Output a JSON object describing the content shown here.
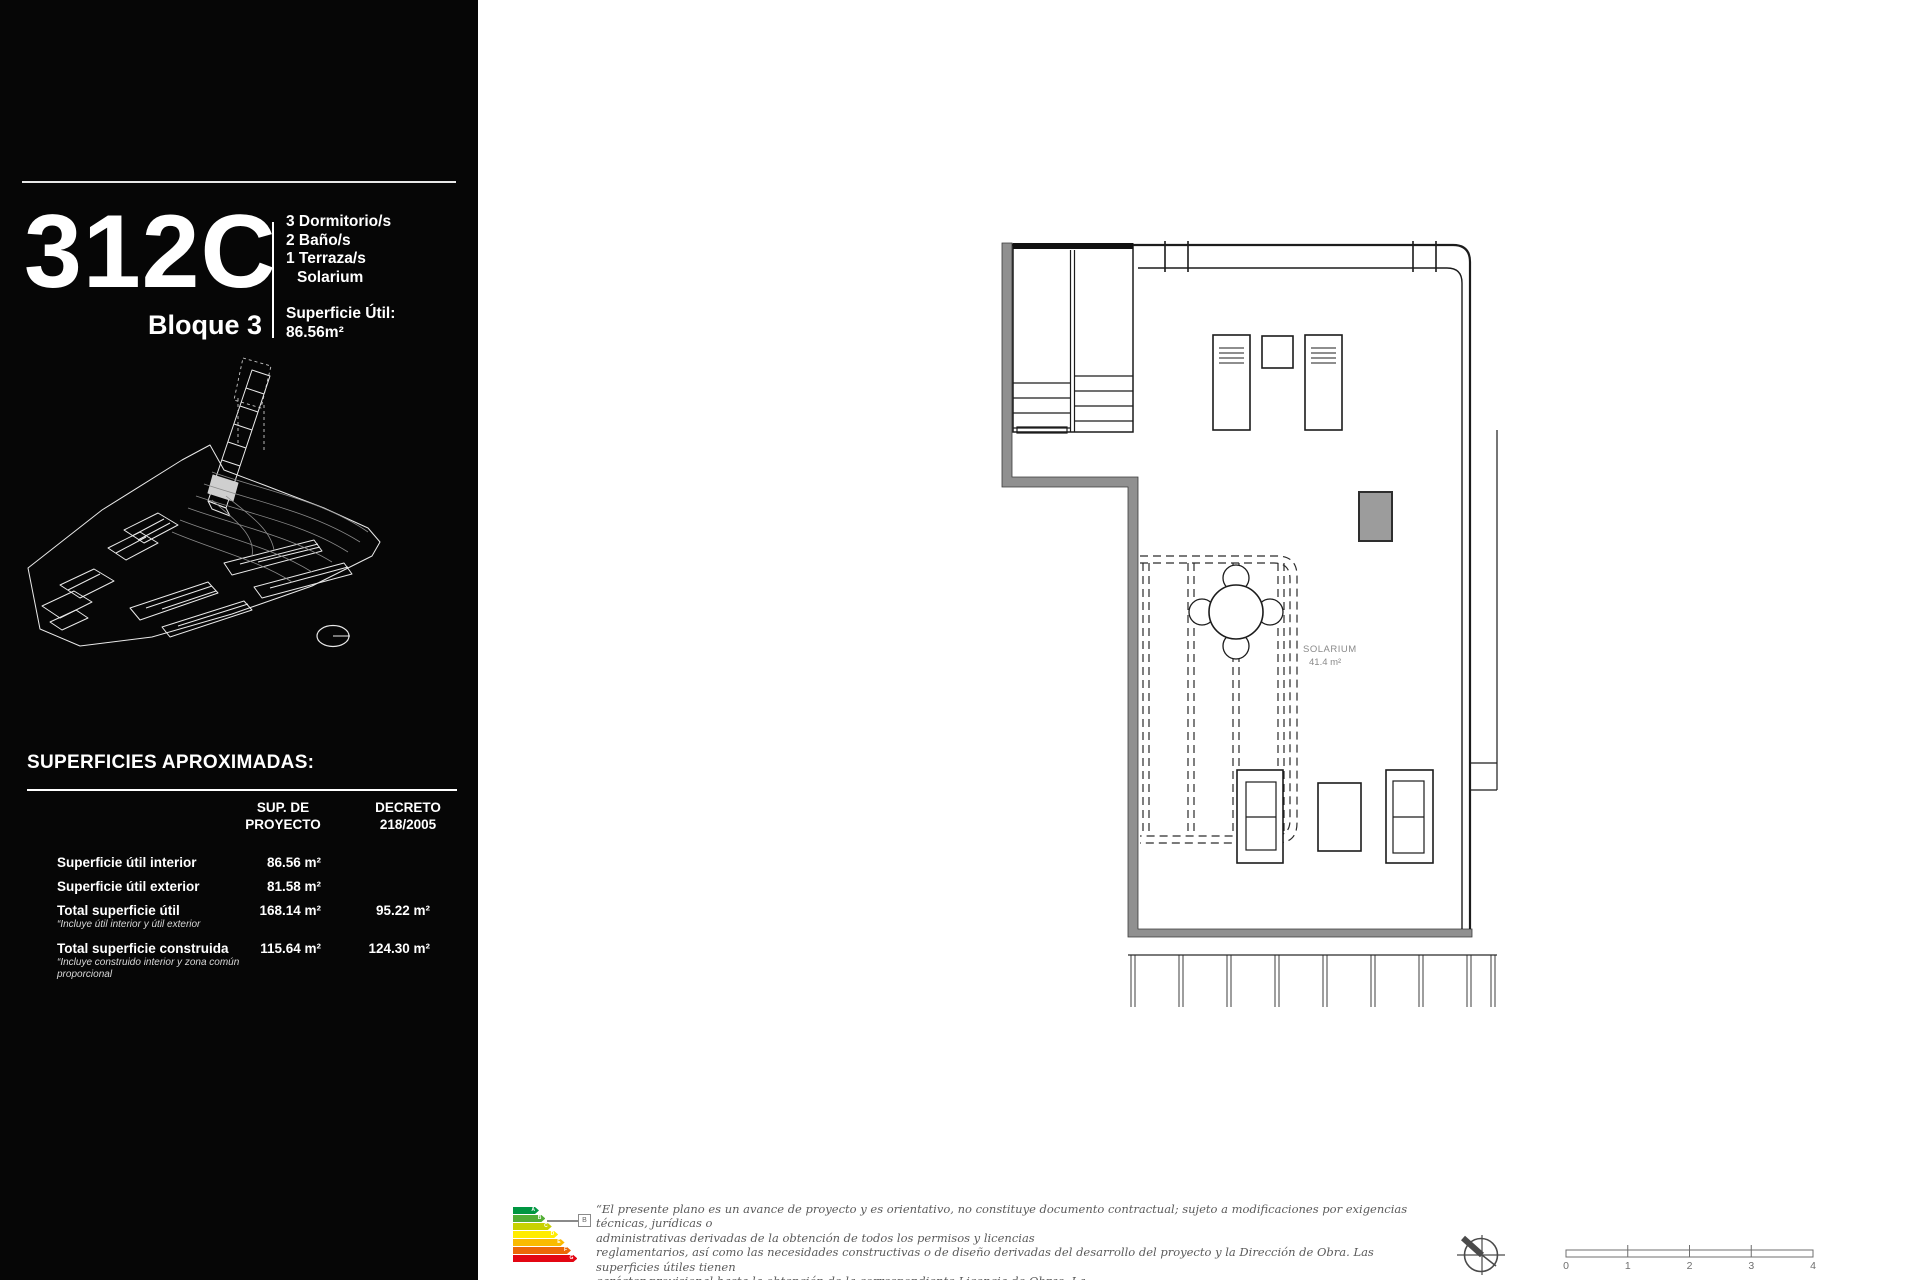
{
  "sidebar": {
    "unit_code": "312C",
    "block_label": "Bloque 3",
    "features": [
      "3 Dormitorio/s",
      "2 Baño/s",
      "1 Terraza/s",
      "Solarium"
    ],
    "superficie_util_label": "Superficie Útil:",
    "superficie_util_value": "86.56m²",
    "surfaces_title": "SUPERFICIES APROXIMADAS:",
    "table": {
      "col1_header": [
        "SUP. DE",
        "PROYECTO"
      ],
      "col2_header": [
        "DECRETO",
        "218/2005"
      ],
      "rows": [
        {
          "label": "Superficie útil interior",
          "note": "",
          "proyecto": "86.56 m²",
          "decreto": ""
        },
        {
          "label": "Superficie útil exterior",
          "note": "",
          "proyecto": "81.58 m²",
          "decreto": ""
        },
        {
          "label": "Total superficie útil",
          "note": "“Incluye útil interior y útil exterior",
          "proyecto": "168.14 m²",
          "decreto": "95.22 m²"
        },
        {
          "label": "Total superficie construida",
          "note": "“Incluye construido interior y zona común proporcional",
          "proyecto": "115.64 m²",
          "decreto": "124.30 m²"
        }
      ]
    }
  },
  "plan": {
    "room_label": "SOLARIUM",
    "room_area": "41.4 m²"
  },
  "footer": {
    "disclaimer_lines": [
      "“El presente plano es un avance de proyecto y es orientativo, no constituye documento contractual; sujeto a modificaciones por exigencias técnicas, jurídicas o",
      "administrativas derivadas de la obtención de todos los permisos y licencias",
      "reglamentarios, así como las necesidades constructivas o de diseño derivadas del desarrollo del proyecto y la Dirección de Obra. Las superficies útiles tienen",
      "carácter provisional hasta la obtención de la correspondiente Licencia de Obras. La",
      "jardinería, el mobiliario urbano y el amueblamiento es ficticio, teniendo validez únicamente a efectos decorativos"
    ],
    "energy": {
      "letters": [
        "A",
        "B",
        "C",
        "D",
        "E",
        "F",
        "G"
      ],
      "colors": [
        "#009641",
        "#52ae34",
        "#c8d200",
        "#ffec00",
        "#faba00",
        "#ec6707",
        "#e30613"
      ],
      "rating": "B"
    },
    "scale_ticks": [
      "0",
      "1",
      "2",
      "3",
      "4"
    ]
  }
}
